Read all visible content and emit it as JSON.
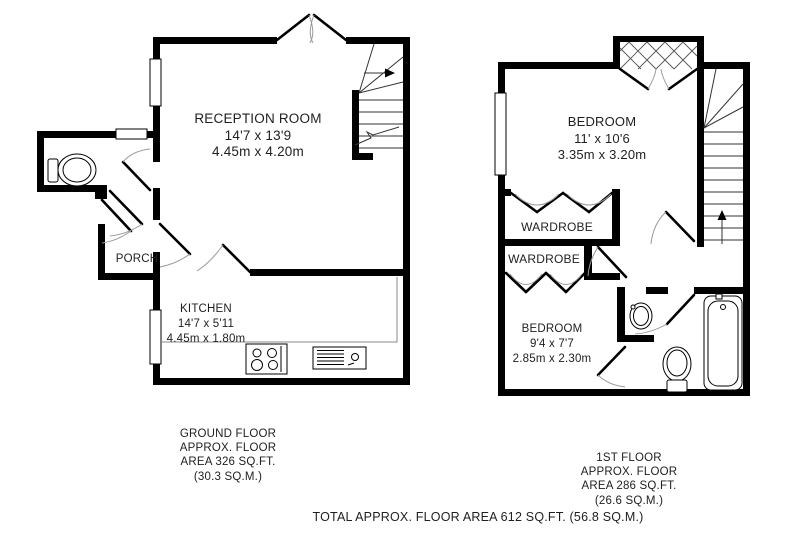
{
  "ground_floor": {
    "rooms": {
      "reception": {
        "name": "RECEPTION ROOM",
        "size_imperial": "14'7 x 13'9",
        "size_metric": "4.45m x 4.20m"
      },
      "kitchen": {
        "name": "KITCHEN",
        "size_imperial": "14'7 x 5'11",
        "size_metric": "4.45m x 1.80m"
      },
      "porch": {
        "name": "PORCH"
      }
    },
    "caption": [
      "GROUND FLOOR",
      "APPROX. FLOOR",
      "AREA 326 SQ.FT.",
      "(30.3 SQ.M.)"
    ]
  },
  "first_floor": {
    "rooms": {
      "bedroom_front": {
        "name": "BEDROOM",
        "size_imperial": "11' x 10'6",
        "size_metric": "3.35m x 3.20m"
      },
      "bedroom_back": {
        "name": "BEDROOM",
        "size_imperial": "9'4 x 7'7",
        "size_metric": "2.85m x 2.30m"
      },
      "wardrobe_1": {
        "name": "WARDROBE"
      },
      "wardrobe_2": {
        "name": "WARDROBE"
      }
    },
    "caption": [
      "1ST FLOOR",
      "APPROX. FLOOR",
      "AREA 286 SQ.FT.",
      "(26.6 SQ.M.)"
    ]
  },
  "total_caption": "TOTAL APPROX. FLOOR AREA 612 SQ.FT. (56.8 SQ.M.)",
  "colors": {
    "walls": "#000000",
    "background": "#ffffff",
    "text": "#1f1f1f"
  }
}
